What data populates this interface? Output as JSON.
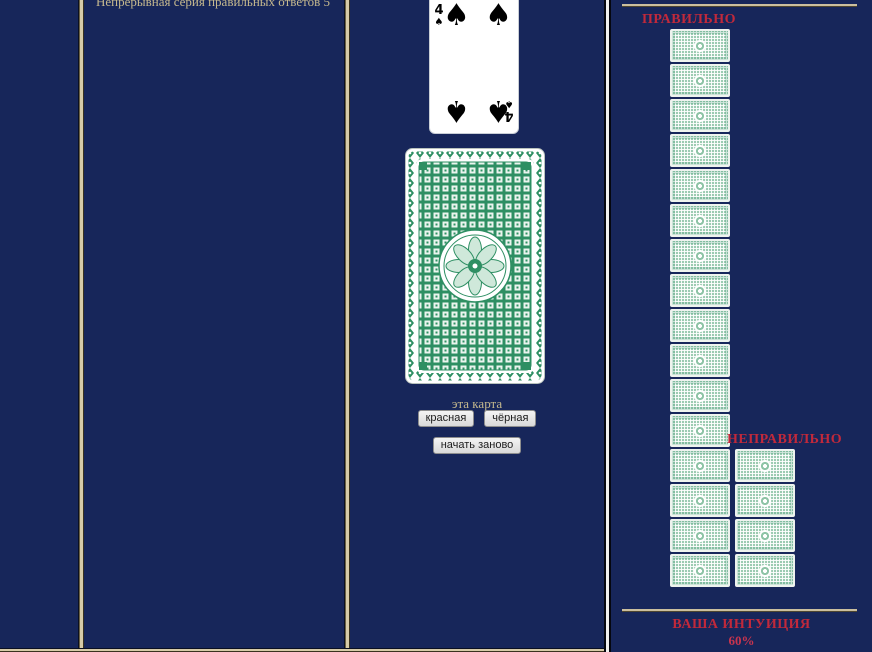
{
  "stats": {
    "streak_text": "Непрерывная серия правильных ответов 5"
  },
  "game": {
    "revealed_card": {
      "rank": "4",
      "suit": "spades",
      "symbol": "♠"
    },
    "prompt": "эта карта",
    "red_button": "красная",
    "black_button": "чёрная",
    "restart_button": "начать заново"
  },
  "results": {
    "correct": {
      "label": "ПРАВИЛЬНО",
      "count": 16
    },
    "incorrect": {
      "label": "НЕПРАВИЛЬНО",
      "count": 4
    },
    "intuition": {
      "label": "ВАША ИНТУИЦИЯ",
      "value": "60%"
    }
  },
  "colors": {
    "navy_background": "#17265a",
    "accent_red": "#c1293b",
    "tan_text": "#c6b98e",
    "card_green": "#2e8f63"
  }
}
